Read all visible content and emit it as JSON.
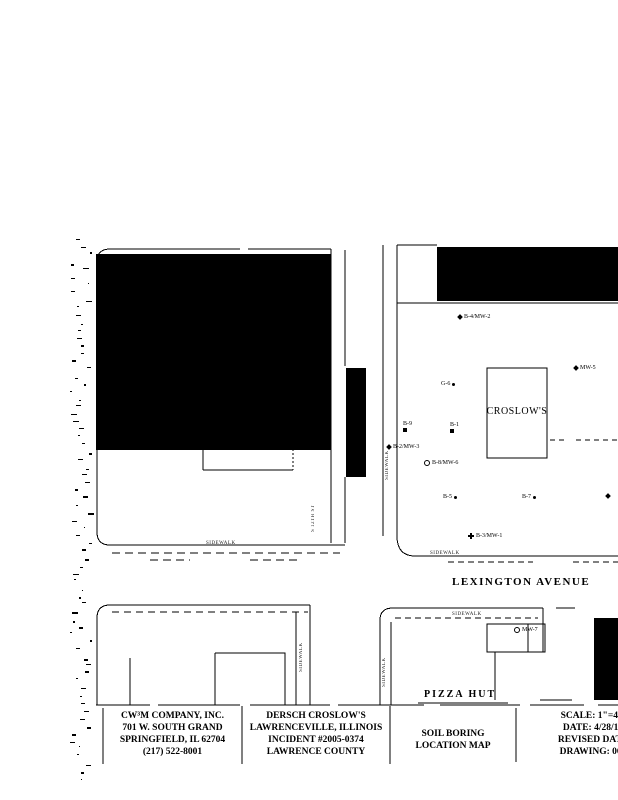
{
  "colors": {
    "ink": "#000000",
    "paper": "#ffffff"
  },
  "map": {
    "streets": {
      "lexington_avenue": "LEXINGTON AVENUE",
      "s_12th_st": "S 12TH ST"
    },
    "sidewalk_label": "SIDEWALK",
    "buildings": {
      "croslows": "CROSLOW'S",
      "pizza_hut": "PIZZA HUT"
    },
    "borings": [
      {
        "label": "B-4/MW-2",
        "marker": "diamond"
      },
      {
        "label": "MW-5",
        "marker": "diamond"
      },
      {
        "label": "G-6",
        "marker": "dot"
      },
      {
        "label": "B-9",
        "marker": "square"
      },
      {
        "label": "B-1",
        "marker": "square"
      },
      {
        "label": "B-2/MW-3",
        "marker": "diamond"
      },
      {
        "label": "B-8/MW-6",
        "marker": "circle"
      },
      {
        "label": "B-5",
        "marker": "dot"
      },
      {
        "label": "B-7",
        "marker": "dot"
      },
      {
        "label": "",
        "marker": "diamond"
      },
      {
        "label": "B-3/MW-1",
        "marker": "plus"
      },
      {
        "label": "MW-7",
        "marker": "circle"
      }
    ]
  },
  "title_block": {
    "company": {
      "lines": [
        "CW³M COMPANY, INC.",
        "701 W. SOUTH GRAND",
        "SPRINGFIELD, IL 62704",
        "(217) 522-8001"
      ]
    },
    "project": {
      "lines": [
        "DERSCH CROSLOW'S",
        "LAWRENCEVILLE, ILLINOIS",
        "INCIDENT #2005-0374",
        "LAWRENCE COUNTY"
      ]
    },
    "sheet_title": {
      "lines": [
        "SOIL BORING",
        "LOCATION MAP"
      ]
    },
    "meta": {
      "lines": [
        "SCALE: 1\"=40'",
        "DATE: 4/28/14",
        "REVISED DATE",
        "DRAWING: 060"
      ]
    }
  }
}
